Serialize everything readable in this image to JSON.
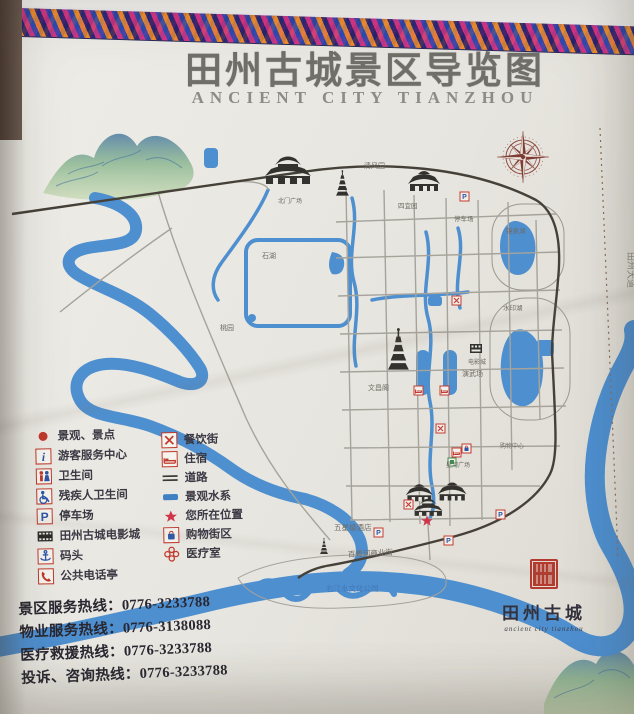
{
  "title": {
    "zh": "田州古城景区导览图",
    "en": "ANCIENT CITY TIANZHOU"
  },
  "legend": {
    "left": [
      {
        "icon": "scenic-spot-dot",
        "label": "景观、景点"
      },
      {
        "icon": "visitor-center",
        "label": "游客服务中心"
      },
      {
        "icon": "toilet",
        "label": "卫生间"
      },
      {
        "icon": "accessible-toilet",
        "label": "残疾人卫生间"
      },
      {
        "icon": "parking",
        "label": "停车场"
      },
      {
        "icon": "cinema",
        "label": "田州古城电影城"
      },
      {
        "icon": "wharf",
        "label": "码头"
      },
      {
        "icon": "public-phone",
        "label": "公共电话亭"
      }
    ],
    "right": [
      {
        "icon": "dining-street",
        "label": "餐饮街"
      },
      {
        "icon": "lodging",
        "label": "住宿"
      },
      {
        "icon": "road",
        "label": "道路"
      },
      {
        "icon": "scenic-water",
        "label": "景观水系"
      },
      {
        "icon": "you-are-here",
        "label": "您所在位置"
      },
      {
        "icon": "shopping-district",
        "label": "购物街区"
      },
      {
        "icon": "medical-room",
        "label": "医疗室"
      }
    ]
  },
  "hotlines": [
    "景区服务热线：0776-3233788",
    "物业服务热线：0776-3138088",
    "医疗救援热线：0776-3233788",
    "投诉、咨询热线：0776-3233788"
  ],
  "branding": {
    "name": "田州古城",
    "script": "ancient city tianzhou"
  },
  "map_labels": {
    "qingfengyuan": "清风园",
    "beimen_square": "北门广场",
    "siyiyuan": "四宜园",
    "parking": "停车场",
    "jingquan_lake": "镜泉湖",
    "shuiyin_lake": "水印湖",
    "shihu": "石湖",
    "taoyuan": "桃园",
    "wenchang_pavilion": "文昌阁",
    "yanwuchang": "演武场",
    "cinema": "电影城",
    "xinghe_square": "星河广场",
    "shopping_center": "购物中心",
    "hotel": "五星级酒店",
    "commercial_street": "百粤河商业街",
    "culture_park": "右江水文化公园",
    "right_road": "田州大道"
  },
  "colors": {
    "water": "#4e8fd0",
    "legend_red": "#c0392b",
    "seal_red": "#b23a2e",
    "dark_line": "#454138"
  }
}
